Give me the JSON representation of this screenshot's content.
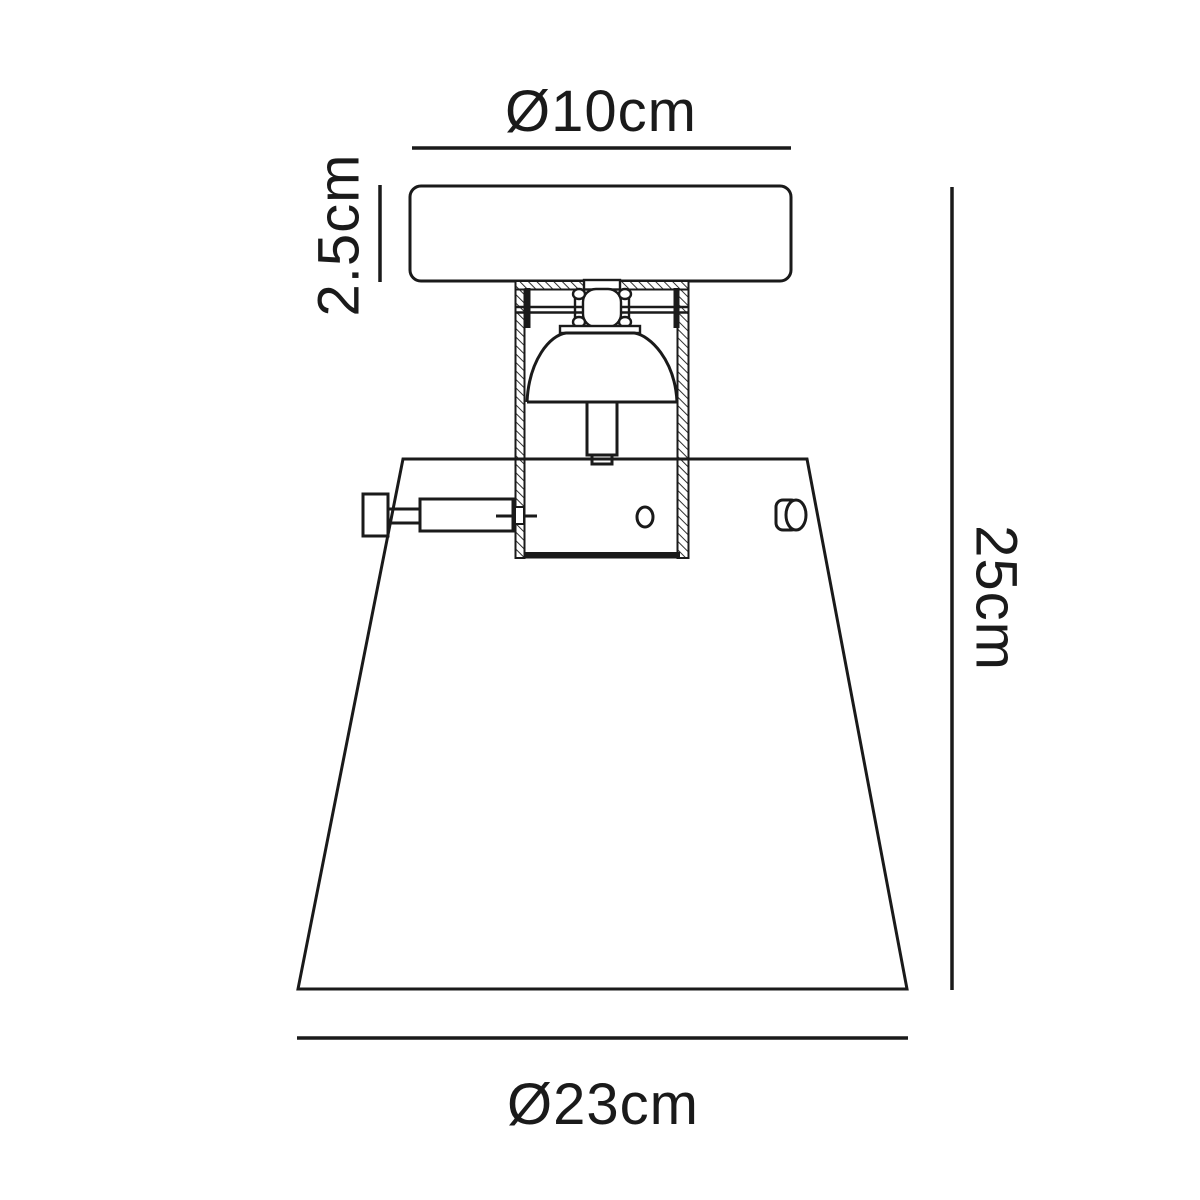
{
  "diagram": {
    "subject": "ceiling-light-fixture-dimension-drawing",
    "labels": {
      "top_diameter": "Ø10cm",
      "canopy_height": "2.5cm",
      "overall_height": "25cm",
      "shade_diameter": "Ø23cm"
    },
    "colors": {
      "line": "#1a1a1a",
      "background": "#ffffff"
    }
  }
}
